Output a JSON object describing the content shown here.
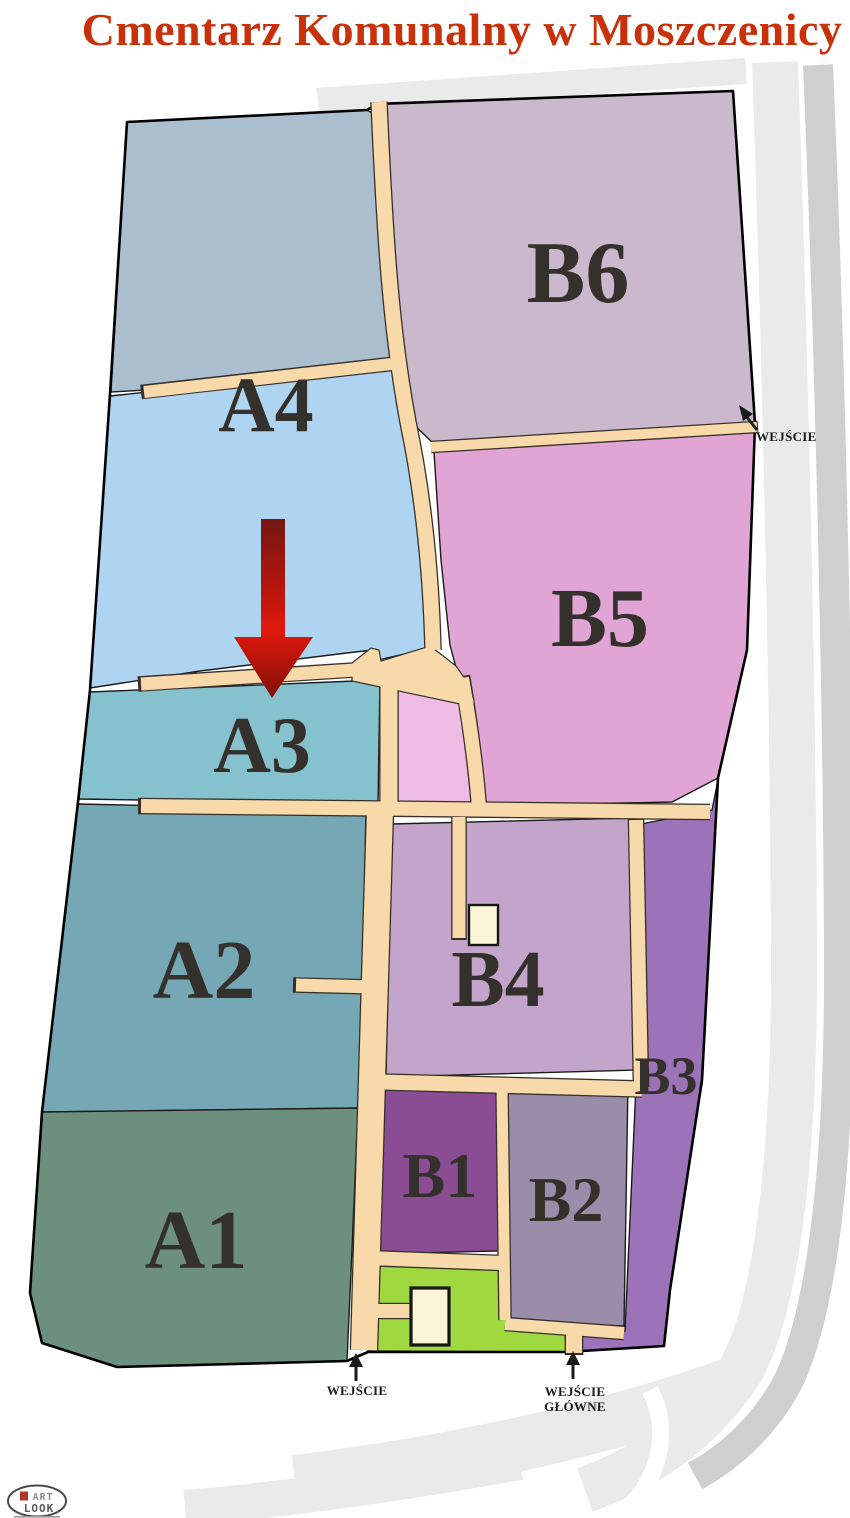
{
  "title": {
    "text": "Cmentarz Komunalny w Moszczenicy",
    "color": "#c8310a"
  },
  "sections": {
    "a1": {
      "label": "A1",
      "color": "#6d8f7e"
    },
    "a2": {
      "label": "A2",
      "color": "#75a7b4"
    },
    "a3": {
      "label": "A3",
      "color": "#86c2ce"
    },
    "a4": {
      "label": "A4",
      "color": "#aed4f1"
    },
    "b1": {
      "label": "B1",
      "color": "#8a4d94"
    },
    "b2": {
      "label": "B2",
      "color": "#9a8da9"
    },
    "b3": {
      "label": "B3",
      "color": "#9c72b9"
    },
    "b4": {
      "label": "B4",
      "color": "#c3a4ca"
    },
    "b5": {
      "label": "B5",
      "color": "#e0a5d5"
    },
    "b6": {
      "label": "B6",
      "color": "#cab8cc"
    },
    "unlabeled": {
      "color": "#abbecd"
    },
    "small_pink": {
      "color": "#edbbe3"
    },
    "green_area": {
      "color": "#a0d840"
    }
  },
  "entrances": {
    "side": {
      "label": "WEJŚCIE"
    },
    "west": {
      "label": "WEJŚCIE"
    },
    "main": {
      "line1": "WEJŚCIE",
      "line2": "GŁÓWNE"
    }
  },
  "map": {
    "path_color": "#f8d9a9",
    "road_color": "#eaeaea",
    "road_dark_color": "#cfcfcf",
    "building_color": "#fbf4d7",
    "marker_color": "#c01008"
  },
  "logo": {
    "line1": "ART",
    "line2": "LOOK"
  }
}
